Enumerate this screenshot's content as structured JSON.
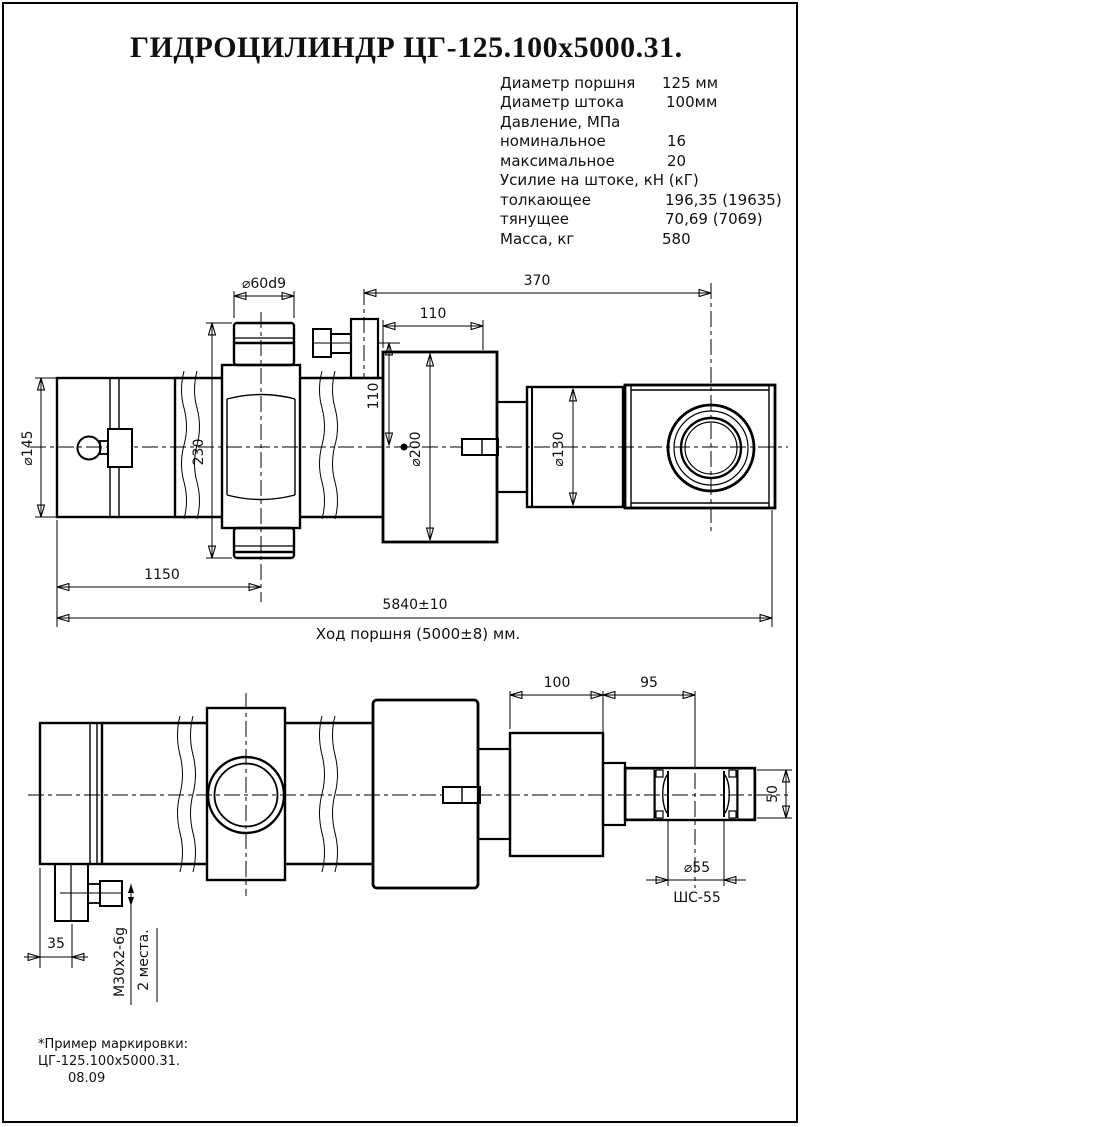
{
  "title": "ГИДРОЦИЛИНДР ЦГ-125.100х5000.31.",
  "specs": {
    "rows": [
      {
        "label": "Диаметр поршня",
        "value": "125 мм"
      },
      {
        "label": "Диаметр штока",
        "value": "100мм"
      },
      {
        "label": "Давление, МПа",
        "value": ""
      },
      {
        "label": "номинальное",
        "value": "16"
      },
      {
        "label": "максимальное",
        "value": "20"
      },
      {
        "label": "Усилие на штоке, кН (кГ)",
        "value": ""
      },
      {
        "label": "толкающее",
        "value": "196,35 (19635)"
      },
      {
        "label": "тянущее",
        "value": "70,69 (7069)"
      },
      {
        "label": "Масса, кг",
        "value": "580"
      }
    ]
  },
  "top_view": {
    "dims": {
      "phi60": "⌀60d9",
      "len370": "370",
      "len110_top": "110",
      "h110": "110",
      "h230": "230",
      "phi145": "⌀145",
      "phi200": "⌀200",
      "phi130": "⌀130",
      "len1150": "1150",
      "total_len": "5840±10",
      "stroke_note": "Ход поршня (5000±8) мм."
    }
  },
  "bottom_view": {
    "dims": {
      "len100": "100",
      "len95": "95",
      "h50": "50",
      "phi55": "⌀55",
      "bearing": "ШС-55",
      "len35": "35",
      "thread": "М30х2-6g",
      "places": "2 места."
    }
  },
  "note": {
    "line1": "*Пример маркировки:",
    "line2": "ЦГ-125.100х5000.31.",
    "line3": "08.09"
  }
}
